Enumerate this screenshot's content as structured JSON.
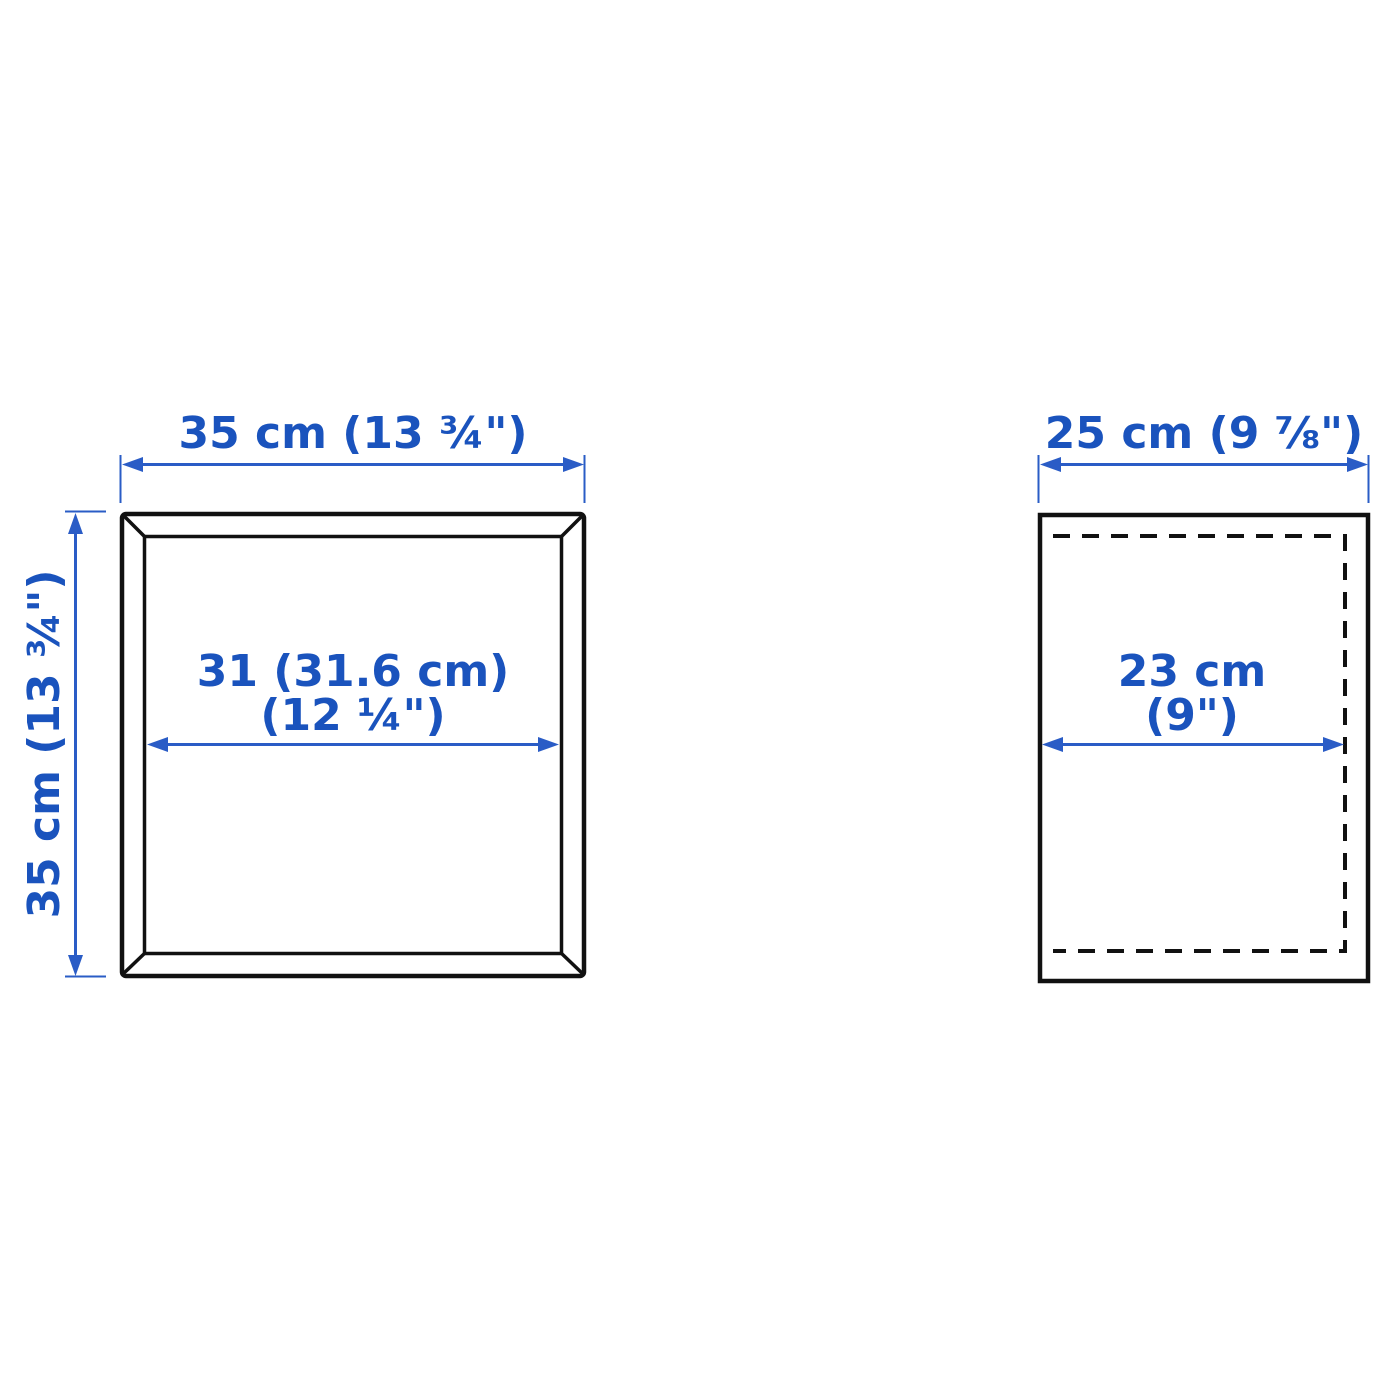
{
  "diagram": {
    "description": "Furniture dimension diagram with front view and side view",
    "front_view": {
      "width_label": "35 cm (13 ¾\")",
      "height_label": "35 cm (13 ¾\")",
      "inner_width_label_line1": "31 (31.6 cm)",
      "inner_width_label_line2": "(12 ¼\")"
    },
    "side_view": {
      "depth_label": "25 cm (9 ⅞\")",
      "inner_depth_label_line1": "23 cm",
      "inner_depth_label_line2": "(9\")"
    }
  },
  "colors": {
    "dimension_text_blue": "#1a53bd",
    "dimension_line_blue": "#2a5cc6",
    "outline_black": "#111111",
    "background": "#ffffff"
  }
}
